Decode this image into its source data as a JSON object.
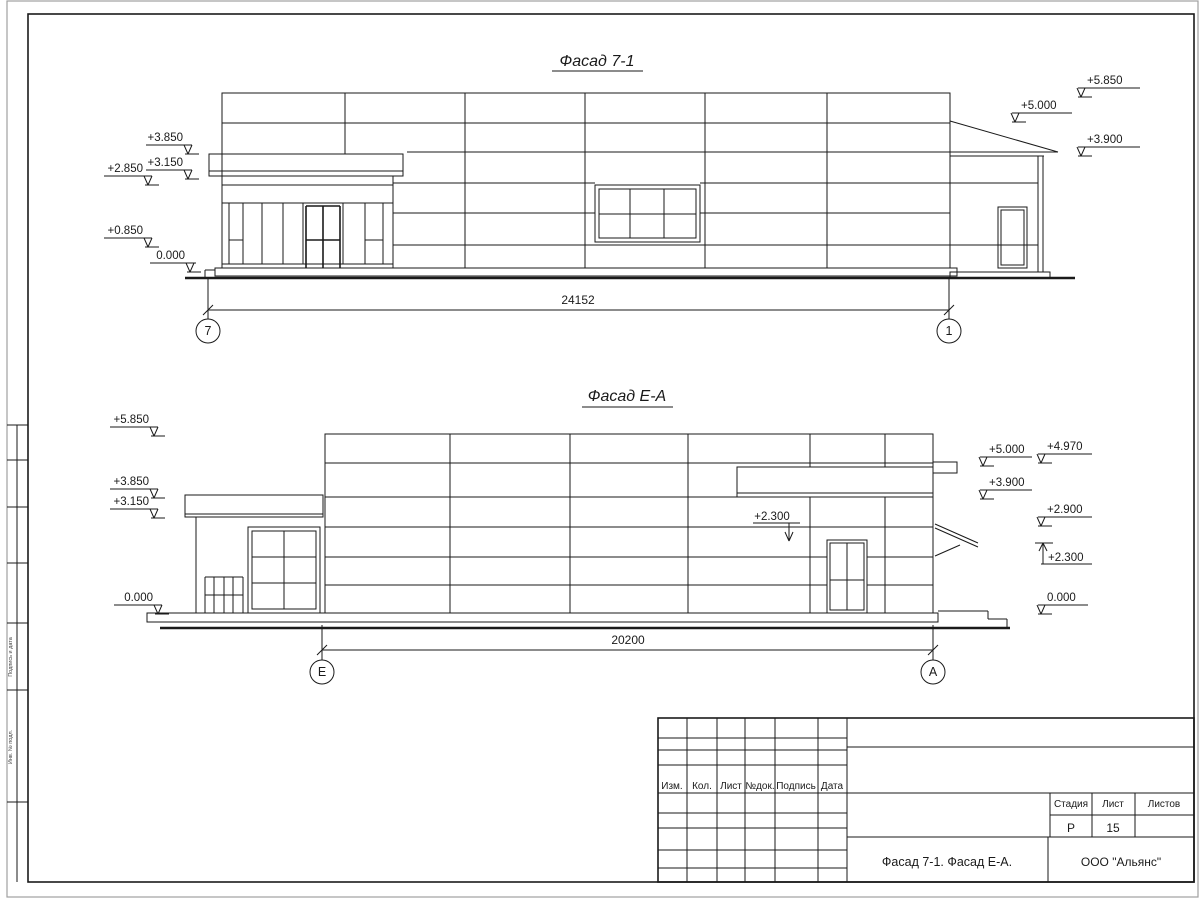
{
  "drawing": {
    "facade1": {
      "title": "Фасад 7-1",
      "dim_label": "24152",
      "axis_left": "7",
      "axis_right": "1",
      "marks_left": [
        "+3.850",
        "+3.150",
        "+2.850",
        "+0.850",
        "0.000"
      ],
      "marks_right": [
        "+5.850",
        "+5.000",
        "+3.900"
      ]
    },
    "facade2": {
      "title": "Фасад Е-А",
      "dim_label": "20200",
      "axis_left": "Е",
      "axis_right": "А",
      "marks_left": [
        "+5.850",
        "+3.850",
        "+3.150",
        "0.000"
      ],
      "marks_right_inner": [
        "+5.000",
        "+3.900"
      ],
      "marks_right_outer": [
        "+4.970",
        "+2.900",
        "+2.300",
        "0.000"
      ],
      "mark_wall": "+2.300"
    },
    "titleblock": {
      "header_cols": [
        "Изм.",
        "Кол.",
        "Лист",
        "№док.",
        "Подпись",
        "Дата"
      ],
      "stage_label": "Стадия",
      "sheet_label": "Лист",
      "sheets_label": "Листов",
      "stage_value": "Р",
      "sheet_value": "15",
      "sheets_value": "",
      "doc_title": "Фасад 7-1. Фасад Е-А.",
      "company": "ООО \"Альянс\""
    },
    "side_stamp": {
      "row1": "Подпись и дата",
      "row2": "Инв. № подл."
    }
  }
}
